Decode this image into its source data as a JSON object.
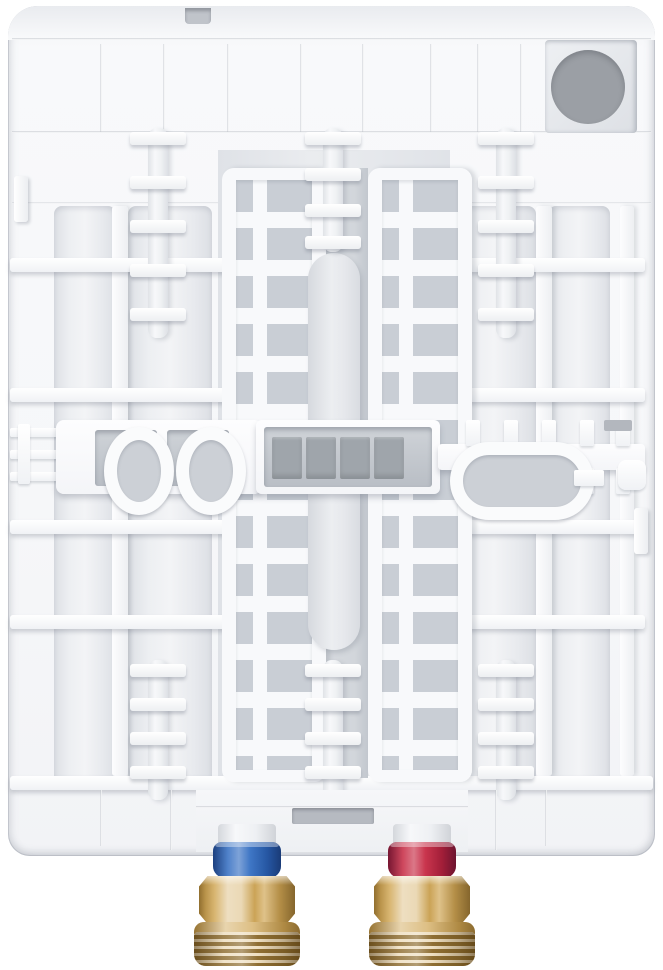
{
  "scene": {
    "type": "product-photo",
    "subject": "water-heater-back-panel",
    "description": "Rear housing of a white instantaneous water heater: molded rib grid and mounting posts, cable-entry hole at top right, two brass pipe connectors at the bottom with a blue ring (left) and a red ring (right)"
  },
  "colors": {
    "background": "#ffffff",
    "gland_hole": "#9b9fa5",
    "terminal_pin": "#9fa5ab",
    "vent_slot": "#b6bac1",
    "top_notch": "#c0c4ca",
    "brass": "#d2aa5c"
  },
  "connections": {
    "left": {
      "type": "cold-inlet",
      "ring_color": "#2e6ac0"
    },
    "right": {
      "type": "hot-outlet",
      "ring_color": "#c5243e"
    }
  }
}
